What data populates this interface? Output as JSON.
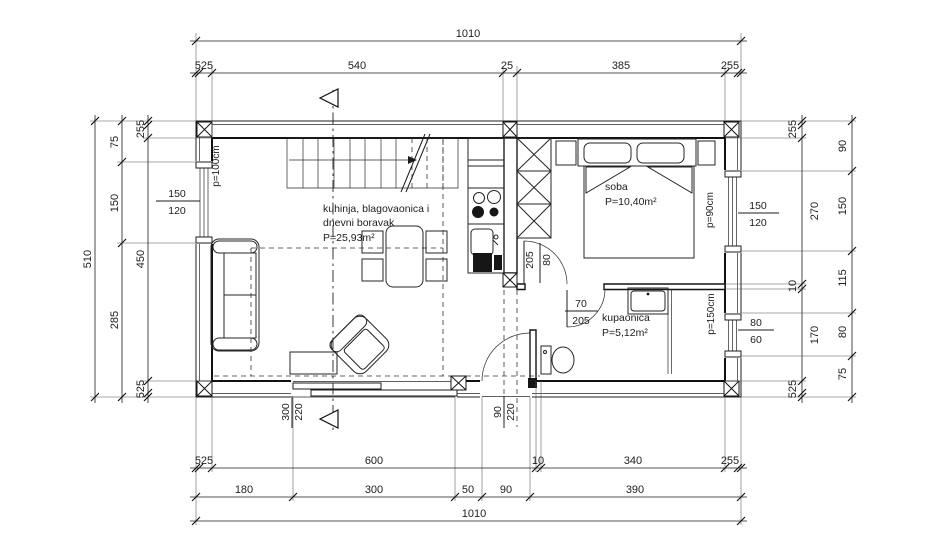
{
  "plan": {
    "rooms": {
      "living": {
        "line1": "kuhinja, blagovaonica i",
        "line2": "dnevni boravak",
        "area": "P=25,93m²"
      },
      "bedroom": {
        "name": "soba",
        "area": "P=10,40m²"
      },
      "bathroom": {
        "name": "kupaonica",
        "area": "P=5,12m²"
      }
    },
    "openings": {
      "window_left": {
        "num": "150",
        "den": "120",
        "parapet": "p=100cm"
      },
      "window_bedroom": {
        "num": "150",
        "den": "120",
        "parapet": "p=90cm"
      },
      "window_bath": {
        "num": "80",
        "den": "60",
        "parapet": "p=150cm"
      },
      "door_bedroom": {
        "num": "80",
        "den": "205"
      },
      "door_bath": {
        "num": "70",
        "den": "205"
      },
      "door_sliding": {
        "num": "300",
        "den": "220"
      },
      "door_entry": {
        "num": "90",
        "den": "220"
      }
    },
    "colors": {
      "line": "#1c1c1c",
      "background": "#ffffff"
    }
  },
  "dims": {
    "top_total": "1010",
    "top_chain": [
      "525",
      "540",
      "25",
      "385",
      "255"
    ],
    "bottom_chain1": [
      "525",
      "600",
      "10",
      "340",
      "255"
    ],
    "bottom_chain2": [
      "180",
      "300",
      "50",
      "90",
      "390"
    ],
    "bottom_total": "1010",
    "left_total": "510",
    "left_outer": [
      "75",
      "150",
      "285"
    ],
    "left_inner": [
      "255",
      "450",
      "525"
    ],
    "right_inner": [
      "255",
      "270",
      "10",
      "170",
      "525"
    ],
    "right_outer": [
      "90",
      "150",
      "115",
      "80",
      "75"
    ]
  }
}
